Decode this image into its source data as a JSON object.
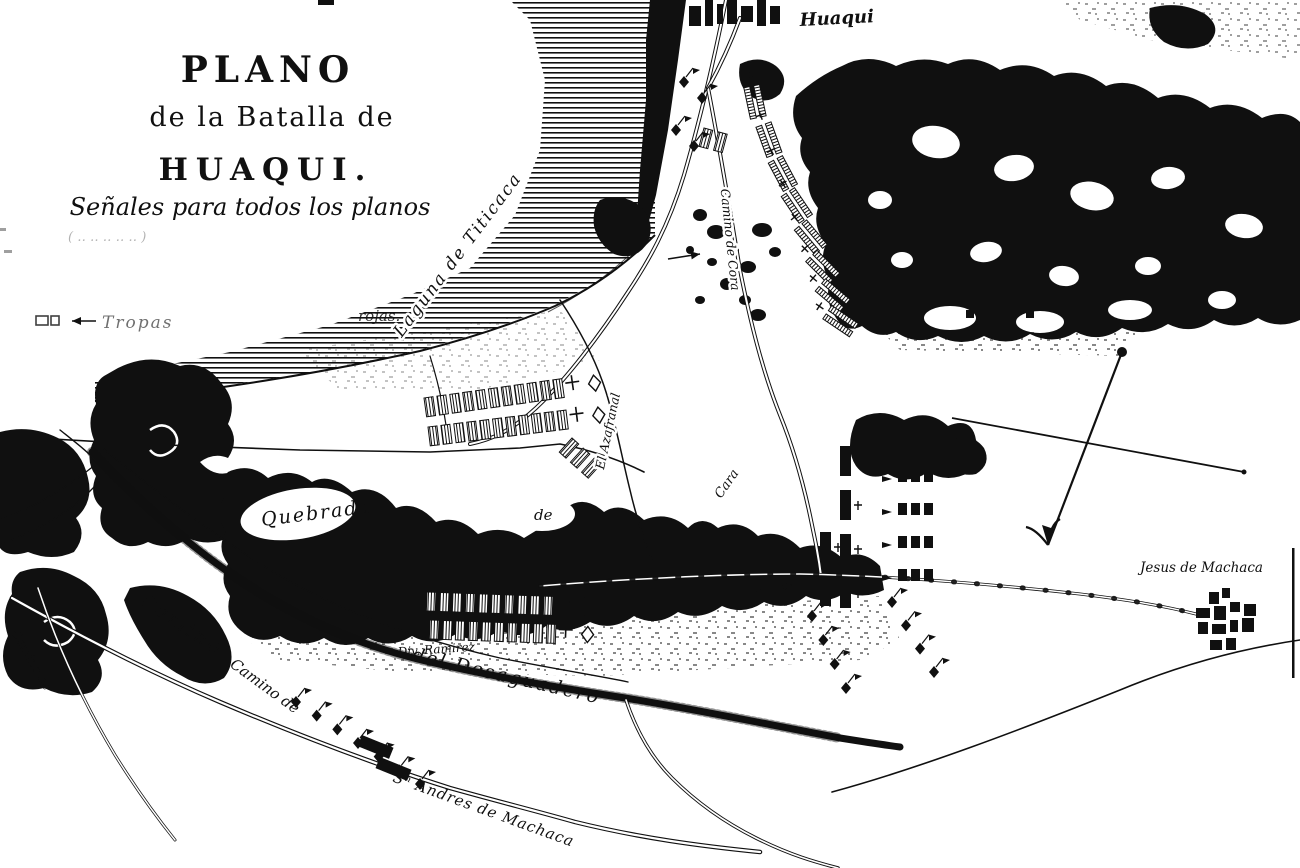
{
  "colors": {
    "ink": "#101010",
    "paper": "#ffffff"
  },
  "title": {
    "plano": "PLANO",
    "line2": "de la Batalla de",
    "huaqui": "HUAQUI.",
    "senales": "Señales para todos los planos",
    "faded_line": "( ‥ ‥ ‥   ‥ ‥ )"
  },
  "legend": {
    "tropas": "Tropas",
    "rojas": "rojas."
  },
  "labels": {
    "huaqui_town": "Huaqui",
    "laguna": "Laguna de Titicaca",
    "camino_cora": "Camino de Cora",
    "el_azafranal": "El Azafranal",
    "quebrada": "Quebrada",
    "de_fragment": "de",
    "cara_fragment": "Cara",
    "camino_desaguadero_1": "Camino",
    "camino_desaguadero_2": "del Desaguadero",
    "div_ramirez": "Div. Ramirez",
    "camino_san_andres_1": "Camino de",
    "camino_san_andres_2": "Sⁿ Andres de Machaca",
    "jesus_de_machaca": "Jesus de Machaca",
    "camino_edge": "Camino de"
  },
  "symbols": {
    "units": [
      {
        "name": "infantry-line-row-1",
        "type": "hatched_row",
        "x": 424,
        "y": 398,
        "count": 11,
        "step": 13,
        "angle": -8,
        "flags": true
      },
      {
        "name": "infantry-line-row-2",
        "type": "hatched_row",
        "x": 428,
        "y": 427,
        "count": 11,
        "step": 13,
        "angle": -7,
        "flags": true
      },
      {
        "name": "skirmish-rects",
        "type": "hatched_row",
        "x": 572,
        "y": 438,
        "count": 3,
        "step": 15,
        "angle": 42,
        "flags": false
      },
      {
        "name": "hatched-pair-upper",
        "type": "hatched_row",
        "x": 704,
        "y": 128,
        "count": 2,
        "step": 15,
        "angle": 15,
        "flags": false
      },
      {
        "name": "reserve-row-1",
        "type": "hatched_row",
        "x": 427,
        "y": 592,
        "count": 10,
        "step": 13,
        "angle": 2,
        "flags": true
      },
      {
        "name": "reserve-row-2",
        "type": "hatched_row",
        "x": 430,
        "y": 620,
        "count": 10,
        "step": 13,
        "angle": 2,
        "flags": true
      },
      {
        "name": "column-bars",
        "type": "bar_column",
        "x": 840,
        "y": 446,
        "count": 4,
        "gap": 44,
        "w": 11,
        "h": 30
      },
      {
        "name": "column-bars-2",
        "type": "bar_column",
        "x": 820,
        "y": 532,
        "count": 2,
        "gap": 44,
        "w": 11,
        "h": 30
      },
      {
        "name": "square-platoons",
        "type": "square_rows",
        "x": 898,
        "y": 470,
        "rows": 4,
        "cols": 3,
        "gapx": 13,
        "gapy": 33
      },
      {
        "name": "cavalry-bottom-road",
        "type": "diamond_line",
        "x1": 296,
        "y1": 702,
        "x2": 420,
        "y2": 784,
        "count": 7
      },
      {
        "name": "cavalry-column-left",
        "type": "diamond_line",
        "x1": 812,
        "y1": 616,
        "x2": 846,
        "y2": 688,
        "count": 4
      },
      {
        "name": "cavalry-column-right",
        "type": "diamond_line",
        "x1": 892,
        "y1": 602,
        "x2": 934,
        "y2": 672,
        "count": 4
      },
      {
        "name": "cavalry-near-huaqui",
        "type": "diamond_line",
        "x1": 684,
        "y1": 82,
        "x2": 702,
        "y2": 98,
        "count": 2
      },
      {
        "name": "cavalry-near-huaqui-2",
        "type": "diamond_line",
        "x1": 676,
        "y1": 130,
        "x2": 694,
        "y2": 146,
        "count": 2
      },
      {
        "name": "arc-position",
        "type": "arc_bars",
        "bars": [
          [
            754,
            102,
            78
          ],
          [
            768,
            140,
            70
          ],
          [
            782,
            174,
            62
          ],
          [
            796,
            206,
            56
          ],
          [
            810,
            238,
            50
          ],
          [
            822,
            268,
            45
          ],
          [
            832,
            296,
            40
          ],
          [
            840,
            322,
            34
          ]
        ]
      },
      {
        "name": "solid-blocks-road",
        "type": "blocks",
        "rects": [
          [
            362,
            735,
            34,
            12,
            22
          ],
          [
            380,
            757,
            34,
            12,
            22
          ]
        ]
      }
    ],
    "movement_arrows": [
      {
        "x1": 668,
        "y1": 259,
        "x2": 700,
        "y2": 254
      },
      {
        "x1": 756,
        "y1": 591,
        "x2": 792,
        "y2": 585
      },
      {
        "x1": 96,
        "y1": 321,
        "x2": 72,
        "y2": 321
      }
    ]
  },
  "villages": {
    "huaqui_blocks": [
      [
        689,
        6,
        12,
        20
      ],
      [
        705,
        0,
        8,
        26
      ],
      [
        717,
        4,
        6,
        20
      ],
      [
        727,
        0,
        10,
        24
      ],
      [
        741,
        6,
        12,
        16
      ],
      [
        757,
        0,
        9,
        26
      ],
      [
        770,
        6,
        10,
        18
      ]
    ],
    "jesus_blocks": [
      [
        1209,
        592,
        10,
        12
      ],
      [
        1222,
        588,
        8,
        10
      ],
      [
        1196,
        608,
        14,
        10
      ],
      [
        1214,
        606,
        12,
        14
      ],
      [
        1230,
        602,
        10,
        10
      ],
      [
        1244,
        604,
        12,
        12
      ],
      [
        1198,
        622,
        10,
        12
      ],
      [
        1212,
        624,
        14,
        10
      ],
      [
        1230,
        620,
        8,
        12
      ],
      [
        1242,
        618,
        12,
        14
      ],
      [
        1210,
        640,
        12,
        10
      ],
      [
        1226,
        638,
        10,
        12
      ]
    ],
    "hillside_squares": [
      [
        948,
        292,
        9,
        9
      ],
      [
        962,
        296,
        8,
        8
      ],
      [
        976,
        290,
        9,
        9
      ],
      [
        990,
        296,
        8,
        8
      ],
      [
        1004,
        290,
        9,
        9
      ],
      [
        1018,
        294,
        8,
        8
      ],
      [
        1032,
        290,
        9,
        9
      ],
      [
        1046,
        294,
        8,
        8
      ],
      [
        966,
        310,
        8,
        8
      ],
      [
        996,
        312,
        8,
        8
      ],
      [
        1026,
        310,
        8,
        8
      ]
    ]
  }
}
